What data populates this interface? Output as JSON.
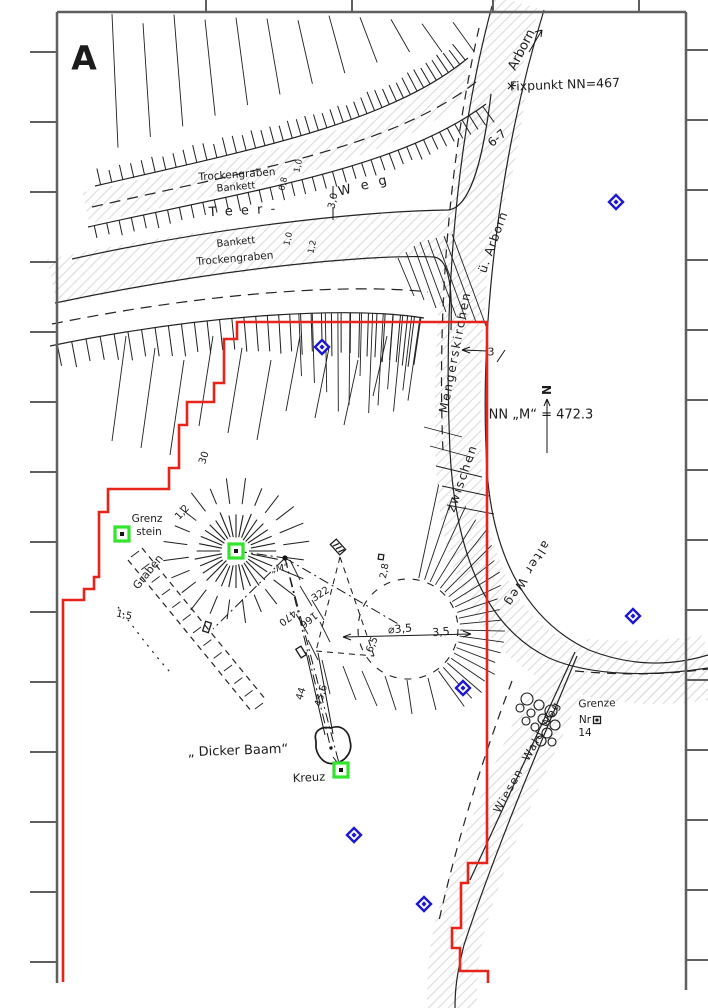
{
  "colors": {
    "boundary": "#e8231a",
    "diamond_blue": "#1c17d2",
    "square_green": "#33e42d",
    "frame": "#5f5f5f",
    "ink": "#1c1c1c",
    "hatch": "#dcdcdc"
  },
  "annotations": [
    {
      "id": "sheet-label",
      "text": "A",
      "x": 84,
      "y": 58,
      "r": 0,
      "s": 33,
      "w": 700
    },
    {
      "id": "arborn-direction",
      "text": "Arborn",
      "x": 522,
      "y": 50,
      "r": -63,
      "s": 13
    },
    {
      "id": "fixpunkt-benchmark",
      "text": "Fixpunkt NN=467",
      "x": 565,
      "y": 85,
      "r": -2,
      "s": 12.5
    },
    {
      "id": "road-width-6-7",
      "text": "6-7",
      "x": 497,
      "y": 138,
      "r": -40,
      "s": 12
    },
    {
      "id": "trockengraben-top",
      "text": "Trockengraben",
      "x": 237,
      "y": 175,
      "r": -4,
      "s": 10.5
    },
    {
      "id": "bankett-top",
      "text": "Bankett",
      "x": 236,
      "y": 188,
      "r": -5,
      "s": 10
    },
    {
      "id": "teer-road",
      "text": "T e e r   -",
      "x": 243,
      "y": 211,
      "r": -3,
      "s": 13,
      "ls": 2
    },
    {
      "id": "road-width-3-0",
      "text": "3,0",
      "x": 334,
      "y": 201,
      "r": -78,
      "s": 10
    },
    {
      "id": "weg-road",
      "text": "W e g",
      "x": 364,
      "y": 186,
      "r": -14,
      "s": 13,
      "ls": 3
    },
    {
      "id": "bankett-bottom",
      "text": "Bankett",
      "x": 236,
      "y": 243,
      "r": -6,
      "s": 10
    },
    {
      "id": "trockengraben-bottom",
      "text": "Trockengraben",
      "x": 235,
      "y": 259,
      "r": -5,
      "s": 10.5
    },
    {
      "id": "measure-1-0-a",
      "text": "1,0",
      "x": 299,
      "y": 166,
      "r": -78,
      "s": 8.5
    },
    {
      "id": "measure-0-8",
      "text": "0,8",
      "x": 284,
      "y": 184,
      "r": -78,
      "s": 8.5
    },
    {
      "id": "measure-1-0-b",
      "text": "1,0",
      "x": 289,
      "y": 239,
      "r": -78,
      "s": 8.5
    },
    {
      "id": "measure-1-2-a",
      "text": "1,2",
      "x": 313,
      "y": 247,
      "r": -78,
      "s": 8.5
    },
    {
      "id": "mengerskirchen",
      "text": "Mengerskirchen",
      "x": 455,
      "y": 352,
      "r": -79,
      "s": 12,
      "ls": 2
    },
    {
      "id": "ue-arborn",
      "text": "ü. Arborn",
      "x": 493,
      "y": 242,
      "r": -70,
      "s": 12,
      "ls": 1
    },
    {
      "id": "zwischen",
      "text": "zwischen",
      "x": 462,
      "y": 478,
      "r": -71,
      "s": 12,
      "ls": 2
    },
    {
      "id": "alter-weg",
      "text": "alter Weg",
      "x": 527,
      "y": 574,
      "r": 122,
      "s": 12,
      "ls": 2
    },
    {
      "id": "north-letter",
      "text": "N",
      "x": 547,
      "y": 390,
      "r": -90,
      "s": 12,
      "w": 600
    },
    {
      "id": "elevation-note",
      "text": "NN „M“ = 472.3",
      "x": 541,
      "y": 415,
      "r": 0,
      "s": 13
    },
    {
      "id": "grenz-line1",
      "text": "Grenz",
      "x": 147,
      "y": 519,
      "r": 0,
      "s": 10.5
    },
    {
      "id": "grenz-line2",
      "text": "stein",
      "x": 149,
      "y": 532,
      "r": 0,
      "s": 10.5
    },
    {
      "id": "graben",
      "text": "Graben",
      "x": 148,
      "y": 572,
      "r": -51,
      "s": 11
    },
    {
      "id": "measure-1-5",
      "text": "1,5",
      "x": 124,
      "y": 616,
      "r": 12,
      "s": 10
    },
    {
      "id": "measure-30",
      "text": "30",
      "x": 205,
      "y": 458,
      "r": -72,
      "s": 10
    },
    {
      "id": "measure-1-2-b",
      "text": "1,2",
      "x": 183,
      "y": 513,
      "r": -48,
      "s": 10
    },
    {
      "id": "measure-322",
      "text": "322",
      "x": 321,
      "y": 595,
      "r": -33,
      "s": 10
    },
    {
      "id": "measure-470",
      "text": "470",
      "x": 287,
      "y": 617,
      "r": 142,
      "s": 10
    },
    {
      "id": "measure-166",
      "text": "166",
      "x": 308,
      "y": 619,
      "r": 142,
      "s": 10
    },
    {
      "id": "measure-45-6",
      "text": "45,6",
      "x": 322,
      "y": 696,
      "r": -73,
      "s": 10
    },
    {
      "id": "measure-44",
      "text": "44",
      "x": 302,
      "y": 694,
      "r": -73,
      "s": 10
    },
    {
      "id": "measure-6-5",
      "text": "6,5",
      "x": 373,
      "y": 645,
      "r": -68,
      "s": 10
    },
    {
      "id": "diameter-3-5",
      "text": "⌀3,5",
      "x": 400,
      "y": 629,
      "r": -5,
      "s": 11
    },
    {
      "id": "measure-3-5",
      "text": "3,5",
      "x": 441,
      "y": 632,
      "r": -5,
      "s": 11
    },
    {
      "id": "measure-2-8",
      "text": "2,8",
      "x": 385,
      "y": 571,
      "r": -80,
      "s": 9.5
    },
    {
      "id": "road-width-3",
      "text": "3",
      "x": 491,
      "y": 352,
      "r": 0,
      "s": 11
    },
    {
      "id": "point-m-label",
      "text": "„M“",
      "x": 280,
      "y": 569,
      "r": -8,
      "s": 9.5
    },
    {
      "id": "dicker-baam",
      "text": "„ Dicker Baam“",
      "x": 238,
      "y": 751,
      "r": -2,
      "s": 13
    },
    {
      "id": "kreuz",
      "text": "Kreuz",
      "x": 309,
      "y": 778,
      "r": -3,
      "s": 11.5
    },
    {
      "id": "grenze",
      "text": "Grenze",
      "x": 597,
      "y": 704,
      "r": -2,
      "s": 10.5
    },
    {
      "id": "grenze-nr",
      "text": "Nr",
      "x": 585,
      "y": 720,
      "r": 0,
      "s": 10.5
    },
    {
      "id": "grenze-nr-14",
      "text": "14",
      "x": 585,
      "y": 733,
      "r": 0,
      "s": 10.5
    },
    {
      "id": "wiesen-wald-weg",
      "text": "Wiesen- Wald Weg",
      "x": 527,
      "y": 757,
      "r": -61,
      "s": 11,
      "ls": 1.5
    }
  ],
  "markers": {
    "blue_diamonds": [
      {
        "x": 616,
        "y": 202
      },
      {
        "x": 322,
        "y": 347
      },
      {
        "x": 633,
        "y": 616
      },
      {
        "x": 463,
        "y": 688
      },
      {
        "x": 354,
        "y": 835
      },
      {
        "x": 424,
        "y": 904
      }
    ],
    "green_squares": [
      {
        "x": 122,
        "y": 534
      },
      {
        "x": 236,
        "y": 551
      },
      {
        "x": 341,
        "y": 770
      }
    ],
    "survey_point_m": {
      "x": 285,
      "y": 558
    }
  }
}
